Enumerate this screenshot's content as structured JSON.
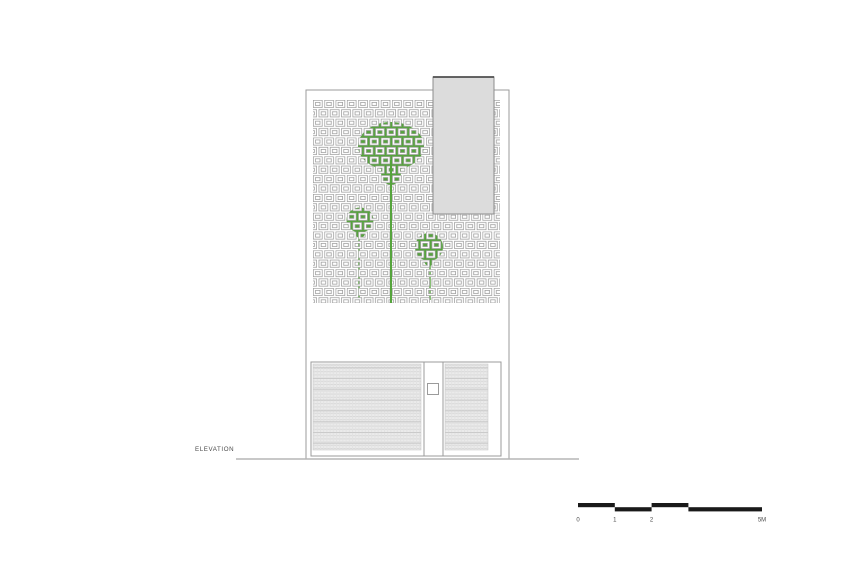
{
  "title": {
    "label": "ELEVATION"
  },
  "colors": {
    "background": "#ffffff",
    "line_gray": "#9b9b9b",
    "light_gray_fill": "#dcdcdc",
    "tower_top_edge": "#4f4f4f",
    "tree_green": "#55a43c",
    "hatch_base": "#ebebeb",
    "hatch_line": "#d8d8d8",
    "hatch_band": "#c9c9c9",
    "ground_line": "#b5b5b5",
    "text_color": "#4a4a4a",
    "scalebar_color": "#1a1a1a"
  },
  "drawing": {
    "building": {
      "x": 306,
      "y": 90,
      "w": 203,
      "h": 369
    },
    "screen": {
      "x": 313,
      "y": 100,
      "w": 187,
      "h": 203
    },
    "tower": {
      "x": 433,
      "y": 77,
      "w": 61,
      "h": 137
    },
    "trees": [
      {
        "name": "large-tree",
        "canopy": {
          "cx": 391,
          "cy": 146,
          "rx": 33,
          "ry": 24
        },
        "bump": {
          "cx": 391,
          "cy": 172,
          "rx": 10,
          "ry": 13
        },
        "trunk": {
          "x": 391,
          "top": 160,
          "bottom": 303,
          "w": 2
        },
        "trunk_on_top": true
      },
      {
        "name": "small-tree-left",
        "canopy": {
          "cx": 360,
          "cy": 220,
          "rx": 13.5,
          "ry": 12.5
        },
        "bump": {
          "cx": 360,
          "cy": 233,
          "rx": 5,
          "ry": 5
        },
        "trunk": {
          "x": 359,
          "top": 236,
          "bottom": 300,
          "w": 1.4
        },
        "trunk_on_top": false
      },
      {
        "name": "small-tree-right",
        "canopy": {
          "cx": 429,
          "cy": 247,
          "rx": 14,
          "ry": 14
        },
        "bump": {
          "cx": 429,
          "cy": 260,
          "rx": 5,
          "ry": 6
        },
        "trunk": {
          "x": 430,
          "top": 262,
          "bottom": 300,
          "w": 1.4
        },
        "trunk_on_top": false
      }
    ],
    "gates": {
      "left": {
        "x": 311,
        "y": 362,
        "w": 113,
        "h": 94,
        "hatch": {
          "x": 313,
          "y": 364,
          "w": 108,
          "h": 86
        }
      },
      "pillar": {
        "x": 424,
        "y": 362,
        "w": 19,
        "h": 94,
        "square": {
          "x": 427.5,
          "y": 383.5,
          "w": 11,
          "h": 11
        }
      },
      "right": {
        "x": 443,
        "y": 362,
        "w": 58,
        "h": 94,
        "hatch": {
          "x": 445,
          "y": 364,
          "w": 43,
          "h": 86
        }
      }
    },
    "ground": {
      "x1": 236,
      "x2": 579,
      "y": 459
    }
  },
  "scale_bar": {
    "x": 578,
    "y": 503,
    "unit_px": 36.8,
    "seg_h": 4.2,
    "segments": [
      {
        "from": 0,
        "to": 1,
        "level": 0
      },
      {
        "from": 1,
        "to": 2,
        "level": 1
      },
      {
        "from": 2,
        "to": 3,
        "level": 0
      },
      {
        "from": 3,
        "to": 5,
        "level": 1
      }
    ],
    "labels": [
      {
        "text": "0",
        "pos": 0
      },
      {
        "text": "1",
        "pos": 1
      },
      {
        "text": "2",
        "pos": 2
      },
      {
        "text": "5M",
        "pos": 5
      }
    ]
  }
}
